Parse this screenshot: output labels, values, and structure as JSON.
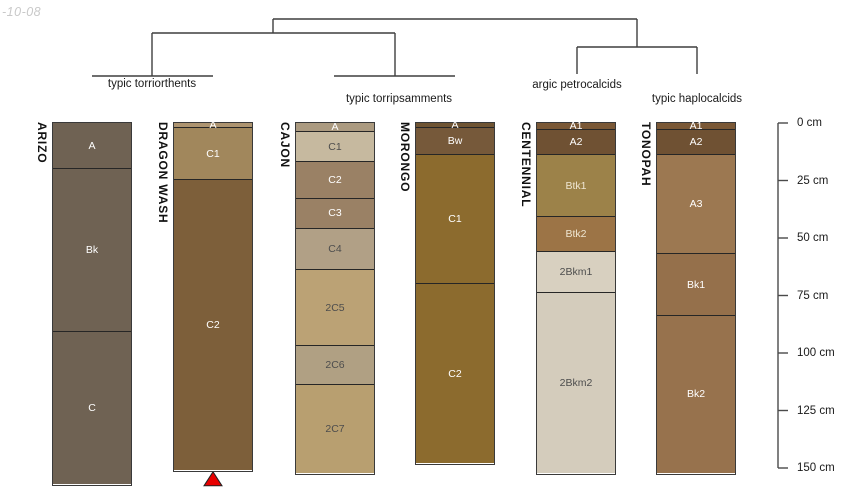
{
  "figure_title": "soil taxonomy dendrogram with profile sketches",
  "watermark": {
    "text": "-10-08"
  },
  "dendrogram": {
    "line_color": "#3f3f3f",
    "segments": [
      [
        273,
        19,
        637,
        19
      ],
      [
        273,
        19,
        273,
        33
      ],
      [
        152,
        33,
        395,
        33
      ],
      [
        152,
        33,
        152,
        76
      ],
      [
        92,
        76,
        213,
        76
      ],
      [
        395,
        33,
        395,
        76
      ],
      [
        334,
        76,
        455,
        76
      ],
      [
        637,
        19,
        637,
        47
      ],
      [
        577,
        47,
        697,
        47
      ],
      [
        577,
        47,
        577,
        74
      ],
      [
        697,
        47,
        697,
        74
      ]
    ],
    "groups": [
      {
        "label": "typic torriorthents",
        "cx": 152,
        "top": 78
      },
      {
        "label": "typic torripsamments",
        "cx": 399,
        "top": 93
      },
      {
        "label": "argic petrocalcids",
        "cx": 577,
        "top": 79
      },
      {
        "label": "typic haplocalcids",
        "cx": 697,
        "top": 93
      }
    ]
  },
  "depth_axis": {
    "x": 778,
    "y0": 123,
    "px_per_cm": 2.3,
    "unit": "cm",
    "line_color": "#4a4a4a",
    "ticks": [
      {
        "label": "0 cm",
        "cm": 0
      },
      {
        "label": "25 cm",
        "cm": 25
      },
      {
        "label": "50 cm",
        "cm": 50
      },
      {
        "label": "75 cm",
        "cm": 75
      },
      {
        "label": "100 cm",
        "cm": 100
      },
      {
        "label": "125 cm",
        "cm": 125
      },
      {
        "label": "150 cm",
        "cm": 150
      }
    ]
  },
  "profiles": [
    {
      "name": "ARIZO",
      "x": 52,
      "width": 80,
      "group": "typic torriorthents",
      "horizons": [
        {
          "name": "A",
          "top_cm": 0,
          "bottom_cm": 20,
          "color": "#6f6253",
          "label_color": "#ffffff"
        },
        {
          "name": "Bk",
          "top_cm": 20,
          "bottom_cm": 91,
          "color": "#6f6253",
          "label_color": "#ffffff"
        },
        {
          "name": "C",
          "top_cm": 91,
          "bottom_cm": 157,
          "color": "#6f6253",
          "label_color": "#ffffff"
        }
      ]
    },
    {
      "name": "DRAGON WASH",
      "x": 173,
      "width": 80,
      "group": "typic torriorthents",
      "marker": {
        "type": "triangle",
        "color": "#e80000",
        "outline": "#222222"
      },
      "horizons": [
        {
          "name": "A",
          "top_cm": 0,
          "bottom_cm": 2,
          "color": "#ad9470",
          "label_color": "#ffffff"
        },
        {
          "name": "C1",
          "top_cm": 2,
          "bottom_cm": 25,
          "color": "#a1875c",
          "label_color": "#ffffff"
        },
        {
          "name": "C2",
          "top_cm": 25,
          "bottom_cm": 151,
          "color": "#7d5f3a",
          "label_color": "#ffffff"
        }
      ]
    },
    {
      "name": "CAJON",
      "x": 295,
      "width": 80,
      "group": "typic torripsamments",
      "horizons": [
        {
          "name": "A",
          "top_cm": 0,
          "bottom_cm": 4,
          "color": "#ab9a80",
          "label_color": "#ffffff"
        },
        {
          "name": "C1",
          "top_cm": 4,
          "bottom_cm": 17,
          "color": "#c6b99f",
          "label_color": "#4d4d4d"
        },
        {
          "name": "C2",
          "top_cm": 17,
          "bottom_cm": 33,
          "color": "#9a8165",
          "label_color": "#ffffff"
        },
        {
          "name": "C3",
          "top_cm": 33,
          "bottom_cm": 46,
          "color": "#9a8165",
          "label_color": "#ffffff"
        },
        {
          "name": "C4",
          "top_cm": 46,
          "bottom_cm": 64,
          "color": "#b1a086",
          "label_color": "#4d4d4d"
        },
        {
          "name": "2C5",
          "top_cm": 64,
          "bottom_cm": 97,
          "color": "#bba275",
          "label_color": "#4d4d4d"
        },
        {
          "name": "2C6",
          "top_cm": 97,
          "bottom_cm": 114,
          "color": "#b0a083",
          "label_color": "#4d4d4d"
        },
        {
          "name": "2C7",
          "top_cm": 114,
          "bottom_cm": 152,
          "color": "#b89f70",
          "label_color": "#4d4d4d"
        }
      ]
    },
    {
      "name": "MORONGO",
      "x": 415,
      "width": 80,
      "group": "typic torripsamments",
      "horizons": [
        {
          "name": "A",
          "top_cm": 0,
          "bottom_cm": 2,
          "color": "#6f5433",
          "label_color": "#ffffff"
        },
        {
          "name": "Bw",
          "top_cm": 2,
          "bottom_cm": 14,
          "color": "#76593a",
          "label_color": "#ffffff"
        },
        {
          "name": "C1",
          "top_cm": 14,
          "bottom_cm": 70,
          "color": "#8c6b2e",
          "label_color": "#ffffff"
        },
        {
          "name": "C2",
          "top_cm": 70,
          "bottom_cm": 148,
          "color": "#8c6b2e",
          "label_color": "#ffffff"
        }
      ]
    },
    {
      "name": "CENTENNIAL",
      "x": 536,
      "width": 80,
      "group": "argic petrocalcids",
      "horizons": [
        {
          "name": "A1",
          "top_cm": 0,
          "bottom_cm": 3,
          "color": "#7a5836",
          "label_color": "#ffffff"
        },
        {
          "name": "A2",
          "top_cm": 3,
          "bottom_cm": 14,
          "color": "#6f5133",
          "label_color": "#ffffff"
        },
        {
          "name": "Btk1",
          "top_cm": 14,
          "bottom_cm": 41,
          "color": "#9c8249",
          "label_color": "#efe6d2"
        },
        {
          "name": "Btk2",
          "top_cm": 41,
          "bottom_cm": 56,
          "color": "#9c7446",
          "label_color": "#efe6d2"
        },
        {
          "name": "2Bkm1",
          "top_cm": 56,
          "bottom_cm": 74,
          "color": "#d8d0c0",
          "label_color": "#4d4d4d"
        },
        {
          "name": "2Bkm2",
          "top_cm": 74,
          "bottom_cm": 152,
          "color": "#d4ccbc",
          "label_color": "#4d4d4d"
        }
      ]
    },
    {
      "name": "TONOPAH",
      "x": 656,
      "width": 80,
      "group": "typic haplocalcids",
      "horizons": [
        {
          "name": "A1",
          "top_cm": 0,
          "bottom_cm": 3,
          "color": "#7a5836",
          "label_color": "#ffffff"
        },
        {
          "name": "A2",
          "top_cm": 3,
          "bottom_cm": 14,
          "color": "#6f5133",
          "label_color": "#ffffff"
        },
        {
          "name": "A3",
          "top_cm": 14,
          "bottom_cm": 57,
          "color": "#9c7851",
          "label_color": "#ffffff"
        },
        {
          "name": "Bk1",
          "top_cm": 57,
          "bottom_cm": 84,
          "color": "#95704b",
          "label_color": "#ffffff"
        },
        {
          "name": "Bk2",
          "top_cm": 84,
          "bottom_cm": 152,
          "color": "#97724d",
          "label_color": "#ffffff"
        }
      ]
    }
  ]
}
